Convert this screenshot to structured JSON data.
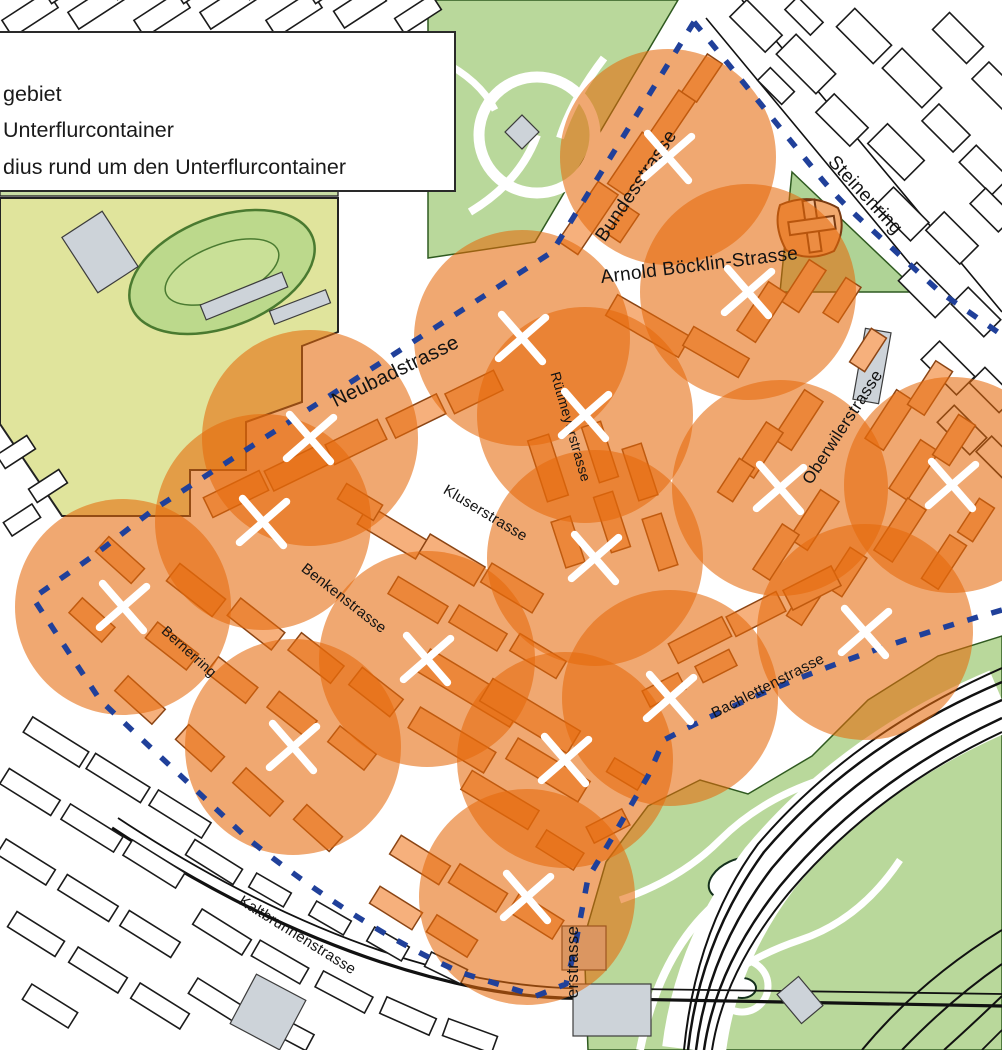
{
  "legend": {
    "items": [
      {
        "label": "gebiet"
      },
      {
        "label": "Unterflurcontainer"
      },
      {
        "label": "dius rund um den Unterflurcontainer"
      }
    ]
  },
  "streets": [
    {
      "name": "Bundesstrasse",
      "x": 641,
      "y": 189,
      "rot": -56,
      "size": 19
    },
    {
      "name": "Steinenring",
      "x": 861,
      "y": 199,
      "rot": 47,
      "size": 19
    },
    {
      "name": "Arnold Böcklin-Strasse",
      "x": 700,
      "y": 271,
      "rot": -7,
      "size": 19
    },
    {
      "name": "Neubadstrasse",
      "x": 398,
      "y": 377,
      "rot": -26,
      "size": 20
    },
    {
      "name": "Rütimeyerstrasse",
      "x": 566,
      "y": 428,
      "rot": 74,
      "size": 14
    },
    {
      "name": "Kluserstrasse",
      "x": 483,
      "y": 517,
      "rot": 31,
      "size": 15
    },
    {
      "name": "Oberwilerstrasse",
      "x": 847,
      "y": 430,
      "rot": -57,
      "size": 17
    },
    {
      "name": "Benkenstrasse",
      "x": 341,
      "y": 602,
      "rot": 38,
      "size": 15
    },
    {
      "name": "Bernerring",
      "x": 186,
      "y": 655,
      "rot": 42,
      "size": 14
    },
    {
      "name": "Bachlettenstrasse",
      "x": 770,
      "y": 690,
      "rot": -27,
      "size": 15
    },
    {
      "name": "Kaltbrunnenstrasse",
      "x": 295,
      "y": 939,
      "rot": 32,
      "size": 15
    },
    {
      "name": "erstrasse",
      "x": 578,
      "y": 962,
      "rot": -90,
      "size": 17
    }
  ],
  "containers": {
    "radius_px": 108,
    "marks": [
      [
        668,
        157
      ],
      [
        748,
        292
      ],
      [
        522,
        338
      ],
      [
        585,
        415
      ],
      [
        310,
        438
      ],
      [
        780,
        488
      ],
      [
        952,
        485
      ],
      [
        263,
        522
      ],
      [
        595,
        558
      ],
      [
        123,
        607
      ],
      [
        865,
        632
      ],
      [
        427,
        659
      ],
      [
        670,
        698
      ],
      [
        293,
        747
      ],
      [
        565,
        760
      ],
      [
        527,
        897
      ]
    ]
  },
  "colors": {
    "zone": "#E5690B",
    "zone_opacity": 0.58,
    "boundary": "#20409A",
    "mark": "#FFFFFF",
    "park": "#B9D89B",
    "field": "#E0E49C",
    "building_inside": "#F6B07C",
    "building_outside": "#FFFFFF",
    "grey_building": "#CDD3D9"
  }
}
